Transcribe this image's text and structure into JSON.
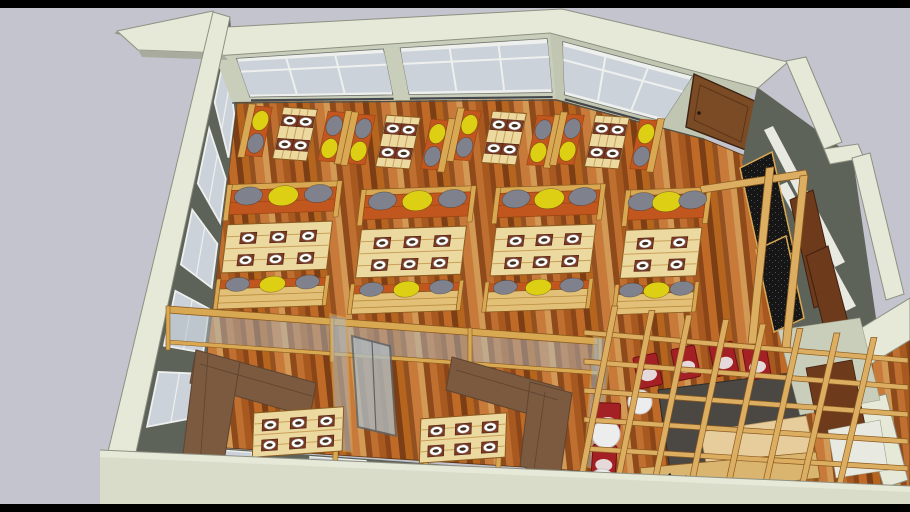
{
  "viewer": {
    "background": "#c3c4cd",
    "letterbox_color": "#000000",
    "letterbox_height_px": 8,
    "description": "3D model viewer - restaurant interior, overhead isometric view"
  },
  "scene": {
    "palette": {
      "wall_rim": "#e7e9d8",
      "wall_rim_dark": "#d8dcc8",
      "wall_rim_edge": "#8e9082",
      "wall_face": "#c9cebb",
      "wall_face_dark": "#c0c6b1",
      "wall_dark": "#5e635a",
      "wall_dark2": "#6d7269",
      "window_glass": "#ccd2da",
      "window_frame": "#eef0ee",
      "window_sill": "#43464a",
      "floor_planks": [
        "#a8591f",
        "#8a4519",
        "#c06a28",
        "#7c3e15",
        "#b5651d",
        "#935121",
        "#c87a3a",
        "#d29a55",
        "#8f4a1c",
        "#bf6f30"
      ],
      "wood": "#d9a853",
      "wood_light": "#ecd9a0",
      "wood_bench": "#e3c078",
      "wood_dark": "#8a5a1f",
      "cushion_orange": "#c1571f",
      "pillow_yellow": "#ddd014",
      "pillow_gray": "#7f828d",
      "placemat": "#7c3a22",
      "plate": "#ffffff",
      "plate_food": "#42301f",
      "door": "#7b4b26",
      "door_frame": "#3a2312",
      "sofa": "#7b5a40",
      "sofa_seam": "#5e4430",
      "chair_red": "#a32125",
      "lamp_white": "#ededed",
      "table_dark": "#4b4742",
      "table_tan": "#e6cd9b",
      "partition_glass": "#aebac0",
      "panel_black": "#161616",
      "panel_brown": "#6e3a1c",
      "shelf_white": "#e8eae2",
      "plant_green": "#2e4a1c",
      "lattice": "#dcae62",
      "lattice_edge": "#8a5a1f"
    },
    "furniture": {
      "window_table_sets": [
        {
          "x": 295,
          "y": 134,
          "rot": 4,
          "pillows": [
            "yellow",
            "gray"
          ]
        },
        {
          "x": 398,
          "y": 142,
          "rot": 4,
          "pillows": [
            "gray",
            "yellow"
          ]
        },
        {
          "x": 504,
          "y": 138,
          "rot": 4,
          "pillows": [
            "yellow",
            "gray"
          ]
        },
        {
          "x": 607,
          "y": 142,
          "rot": 4,
          "pillows": [
            "gray",
            "yellow"
          ]
        }
      ],
      "booths": [
        {
          "x": 277,
          "y": 247,
          "w": 105,
          "cols": 3
        },
        {
          "x": 411,
          "y": 252,
          "w": 105,
          "cols": 3
        },
        {
          "x": 543,
          "y": 250,
          "w": 100,
          "cols": 3
        },
        {
          "x": 661,
          "y": 253,
          "w": 76,
          "cols": 2
        }
      ],
      "private_tables": [
        {
          "x": 298,
          "y": 432,
          "rot": -4,
          "w": 90,
          "cols": 3
        },
        {
          "x": 463,
          "y": 438,
          "rot": -4,
          "w": 86,
          "cols": 3
        }
      ],
      "lounge_chairs": [
        {
          "x": 648,
          "y": 372,
          "rot": -12
        },
        {
          "x": 686,
          "y": 364,
          "rot": -12
        },
        {
          "x": 724,
          "y": 360,
          "rot": -12
        },
        {
          "x": 757,
          "y": 364,
          "rot": -10
        },
        {
          "x": 608,
          "y": 420,
          "rot": 2
        },
        {
          "x": 604,
          "y": 462,
          "rot": 4
        }
      ],
      "sphere_lamps": [
        {
          "x": 640,
          "y": 402,
          "r": 12
        },
        {
          "x": 606,
          "y": 434,
          "r": 14
        },
        {
          "x": 602,
          "y": 482,
          "r": 13
        }
      ],
      "shoes": [
        {
          "x": 668,
          "y": 477
        },
        {
          "x": 684,
          "y": 479
        },
        {
          "x": 700,
          "y": 481
        }
      ],
      "plants": [
        {
          "x": 745,
          "y": 492
        },
        {
          "x": 762,
          "y": 496
        },
        {
          "x": 800,
          "y": 492
        },
        {
          "x": 816,
          "y": 495
        }
      ]
    },
    "counts": {
      "window_tables": 4,
      "booths": 4,
      "private_rooms": 2,
      "top_wall_windows": 3,
      "left_wall_windows": 5
    }
  }
}
